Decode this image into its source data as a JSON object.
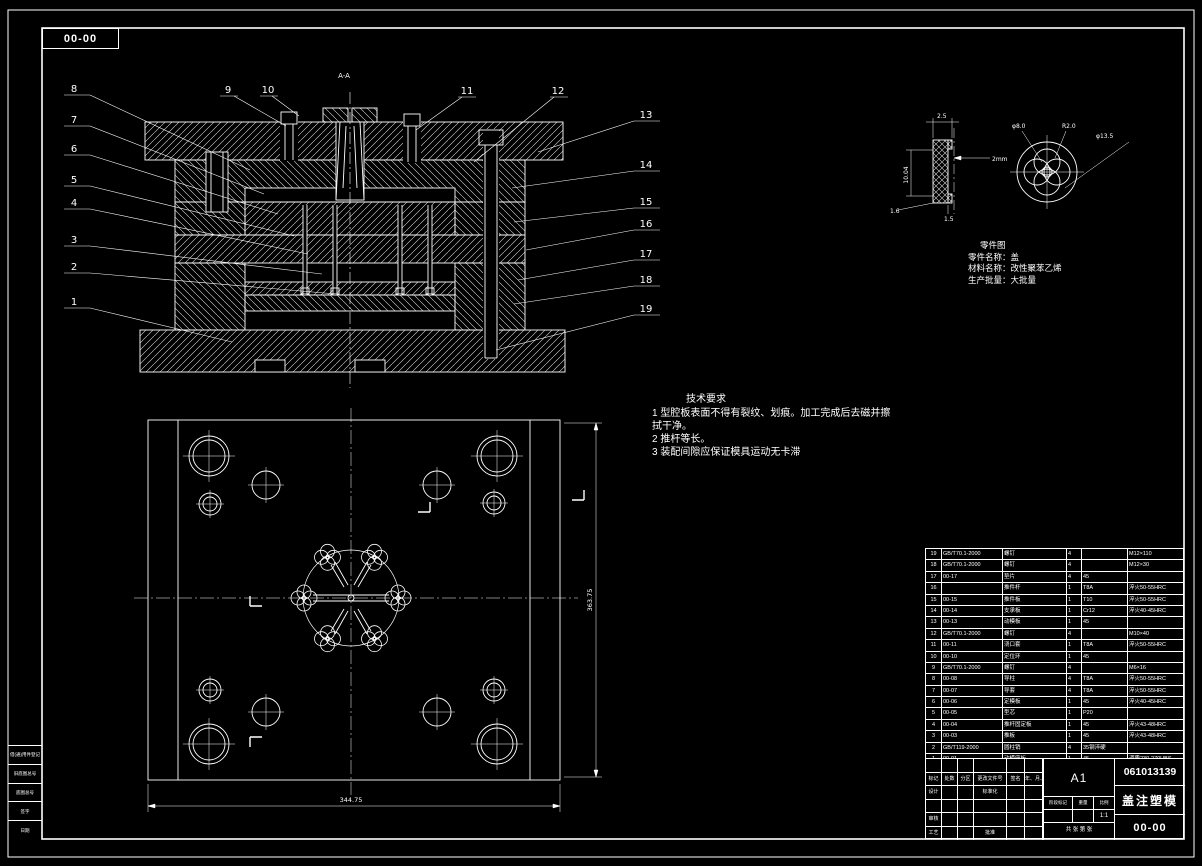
{
  "frame": {
    "sheet_code": "00-00",
    "edge_labels": [
      "借(通)用件登记",
      "旧底图总号",
      "底图总号",
      "签字",
      "日期"
    ]
  },
  "callouts": {
    "left": [
      "8",
      "7",
      "6",
      "5",
      "4",
      "3",
      "2",
      "1"
    ],
    "top": [
      "9",
      "10",
      "11",
      "12"
    ],
    "right": [
      "13",
      "14",
      "15",
      "16",
      "17",
      "18",
      "19"
    ],
    "section": "A-A"
  },
  "tech": {
    "title": "技术要求",
    "lines": [
      "1 型腔板表面不得有裂纹、划痕。加工完成后去磁并擦",
      "拭干净。",
      "2 推杆等长。",
      "3 装配间隙应保证模具运动无卡滞"
    ]
  },
  "part_info": {
    "title": "零件图",
    "name_line": "零件名称：盖",
    "material_line": "材料名称：改性聚苯乙烯",
    "batch_line": "生产批量：大批量"
  },
  "detail": {
    "dim_thickness": "2.5",
    "dim_height": "10.04",
    "dim_a": "1.6",
    "dim_b": "1.5",
    "dim_wall": "2mm",
    "dia_small": "φ8.0",
    "radius": "R2.0",
    "dia_large": "φ13.5"
  },
  "plan": {
    "dim_bottom": "344.75",
    "dim_right": "363.75"
  },
  "bom": {
    "headers": [
      "序号",
      "代号",
      "名称",
      "数量",
      "材料",
      "备注"
    ],
    "rows": [
      [
        "19",
        "GB/T70.1-2000",
        "螺钉",
        "4",
        "",
        "M12×110"
      ],
      [
        "18",
        "GB/T70.1-2000",
        "螺钉",
        "4",
        "",
        "M12×30"
      ],
      [
        "17",
        "00-17",
        "垫片",
        "4",
        "45",
        ""
      ],
      [
        "16",
        "",
        "推件杆",
        "1",
        "T8A",
        "淬火50-55HRC"
      ],
      [
        "15",
        "00-15",
        "推件板",
        "1",
        "T10",
        "淬火50-55HRC"
      ],
      [
        "14",
        "00-14",
        "支承板",
        "1",
        "Cr12",
        "淬火40-45HRC"
      ],
      [
        "13",
        "00-13",
        "动模板",
        "1",
        "45",
        ""
      ],
      [
        "12",
        "GB/T70.1-2000",
        "螺钉",
        "4",
        "",
        "M10×40"
      ],
      [
        "11",
        "00-11",
        "浇口套",
        "1",
        "T8A",
        "淬火50-55HRC"
      ],
      [
        "10",
        "00-10",
        "定位环",
        "1",
        "45",
        ""
      ],
      [
        "9",
        "GB/T70.1-2000",
        "螺钉",
        "4",
        "",
        "M6×16"
      ],
      [
        "8",
        "00-08",
        "导柱",
        "4",
        "T8A",
        "淬火50-55HRC"
      ],
      [
        "7",
        "00-07",
        "导套",
        "4",
        "T8A",
        "淬火50-55HRC"
      ],
      [
        "6",
        "00-06",
        "定模板",
        "1",
        "45",
        "淬火40-45HRC"
      ],
      [
        "5",
        "00-05",
        "型芯",
        "1",
        "P20",
        ""
      ],
      [
        "4",
        "00-04",
        "推杆固定板",
        "1",
        "45",
        "淬火43-48HRC"
      ],
      [
        "3",
        "00-03",
        "推板",
        "1",
        "45",
        "淬火43-48HRC"
      ],
      [
        "2",
        "GB/T119-2000",
        "圆柱销",
        "4",
        "35钢淬硬",
        ""
      ],
      [
        "1",
        "00-01",
        "动模座板",
        "1",
        "45",
        "调质230-270HBS"
      ]
    ]
  },
  "title_block": {
    "drawing_no": "061013139",
    "product_name": "盖注塑模",
    "sheet_code": "00-00",
    "paper_size": "A1",
    "scale": "1:1",
    "sheet_note": "共 张 第 张",
    "stage_labels": [
      "阶段标记",
      "重量",
      "比例"
    ],
    "left_rows": [
      [
        "",
        "",
        "",
        "",
        "",
        ""
      ],
      [
        "标记",
        "处数",
        "分区",
        "更改文件号",
        "签名",
        "年、月、日"
      ],
      [
        "设计",
        "",
        "",
        "标准化",
        "",
        ""
      ],
      [
        "",
        "",
        "",
        "",
        "",
        ""
      ],
      [
        "审核",
        "",
        "",
        "",
        "",
        ""
      ],
      [
        "工艺",
        "",
        "",
        "批准",
        "",
        ""
      ]
    ]
  }
}
